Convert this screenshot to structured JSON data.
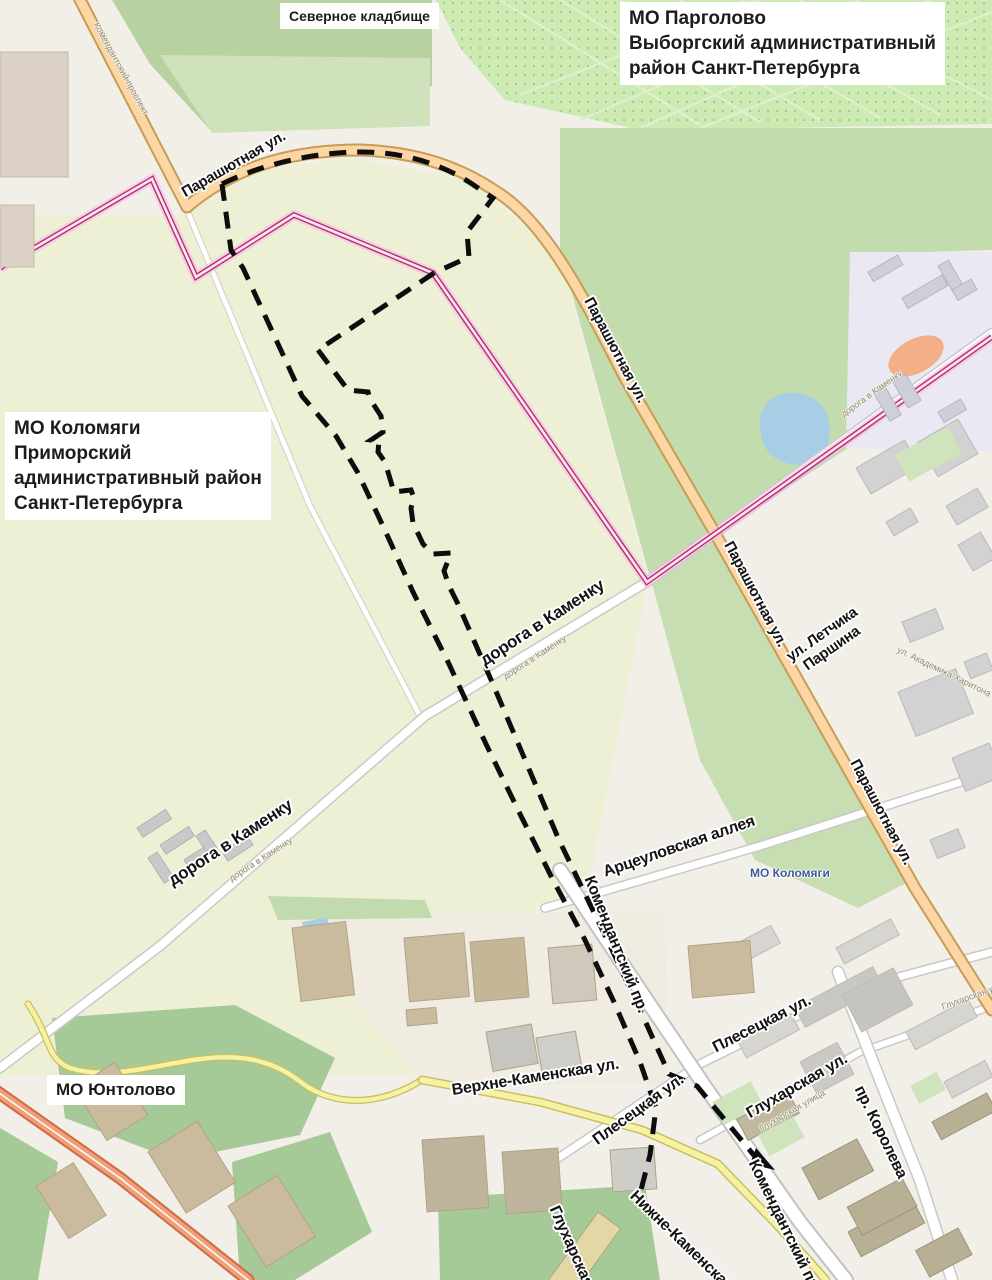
{
  "annotations": {
    "severnoe_kladbishche": "Северное кладбище",
    "pargolovo": [
      "МО Парголово",
      "Выборгский административный",
      "район Санкт-Петербурга"
    ],
    "kolomyagi": [
      "МО Коломяги",
      "Приморский",
      "административный район",
      "Санкт-Петербурга"
    ],
    "yuntolovo": "МО Юнтолово",
    "kolomyagi_map_label": "МО Коломяги"
  },
  "streets": {
    "parashyutnaya": "Парашютная ул.",
    "letchika_1": "ул. Летчика",
    "letchika_2": "Паршина",
    "doroga_v_kamenku": "дорога в Каменку",
    "artseulovskaya": "Арцеуловская аллея",
    "komendantsky_pr": "Комендантский пр.",
    "plesetskaya": "Плесецкая ул.",
    "verkhne_kamenskaya": "Верхне-Каменская ул.",
    "nizhne_kamenskaya": "Нижне-Каменская ул.",
    "glukharskaya": "Глухарская ул.",
    "glukharskaya_full": "Глухарская улица",
    "glukharskaya_short": "Глухарская ул",
    "koroleva": "пр. Королева",
    "komendantsky_prospekt": "Комендантский проспект",
    "akademika_kharitona": "ул. Академика Харитона"
  },
  "colors": {
    "boundary_dash": "#0d0d0d",
    "admin_boundary": "#c32789",
    "road_primary": "#fcd6a4",
    "road_yellow": "#f6f2a2",
    "road_trunk": "#f0a077",
    "water": "#a8cee6",
    "cemetery": "#cdeab3",
    "district_label_blue": "#3d5b96"
  }
}
